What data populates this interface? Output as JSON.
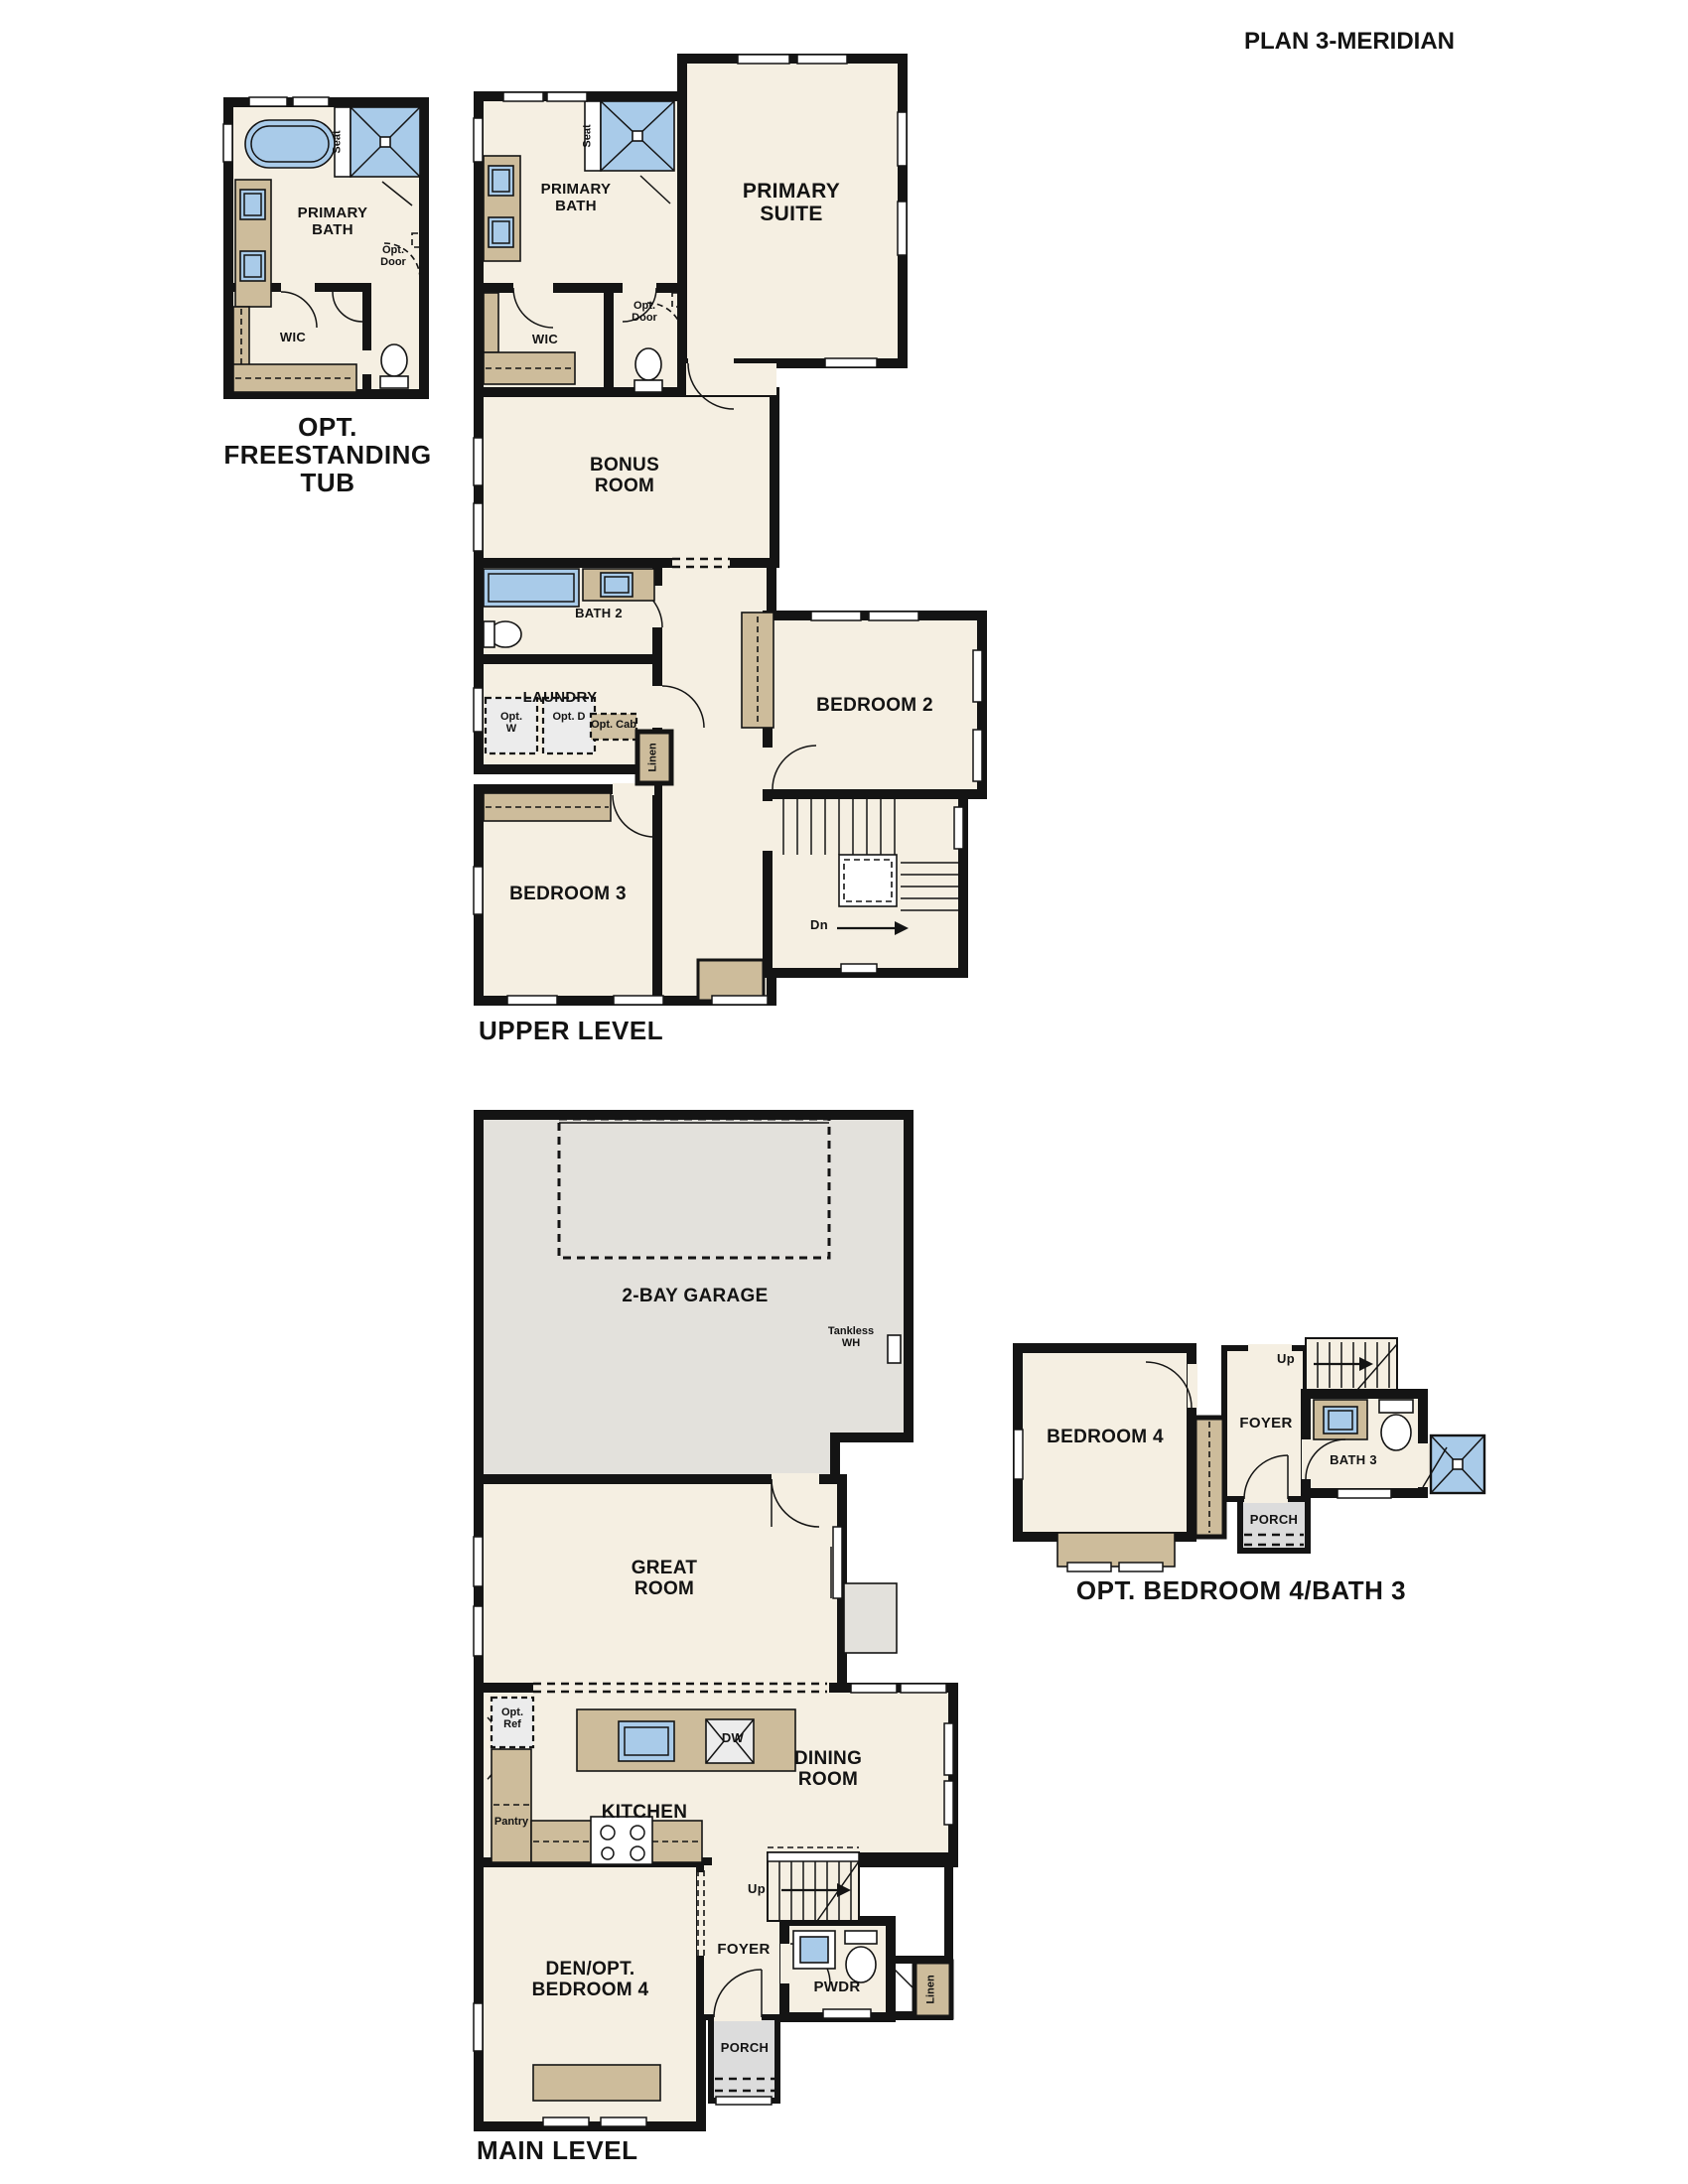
{
  "title": "PLAN 3-MERIDIAN",
  "colors": {
    "floor_cream": "#f5efe2",
    "wall_black": "#141414",
    "fixture_blue": "#a9cbe9",
    "cabinet_tan": "#cdbc9b",
    "garage_gray": "#e3e1dc",
    "porch_gray": "#dcdcdc"
  },
  "opt_tub_detail": {
    "caption": "OPT. FREESTANDING TUB",
    "primary_bath": "PRIMARY BATH",
    "wic": "WIC",
    "seat": "Seat",
    "opt_door": "Opt. Door"
  },
  "upper_level": {
    "caption": "UPPER LEVEL",
    "primary_suite": "PRIMARY SUITE",
    "primary_bath": "PRIMARY BATH",
    "wic": "WIC",
    "seat": "Seat",
    "opt_door": "Opt. Door",
    "bonus_room": "BONUS ROOM",
    "bath_2": "BATH 2",
    "laundry": "LAUNDRY",
    "opt_w": "Opt. W",
    "opt_d": "Opt. D",
    "opt_cab": "Opt. Cab",
    "linen": "Linen",
    "bedroom_2": "BEDROOM 2",
    "bedroom_3": "BEDROOM 3",
    "dn": "Dn"
  },
  "main_level": {
    "caption": "MAIN LEVEL",
    "garage": "2-BAY GARAGE",
    "tankless_wh": "Tankless WH",
    "great_room": "GREAT ROOM",
    "opt_ref": "Opt. Ref",
    "kitchen": "KITCHEN",
    "dw": "DW",
    "pantry": "Pantry",
    "dining_room": "DINING ROOM",
    "up": "Up",
    "den": "DEN/OPT. BEDROOM 4",
    "foyer": "FOYER",
    "pwdr": "PWDR",
    "linen": "Linen",
    "porch": "PORCH"
  },
  "opt_bed4_detail": {
    "caption": "OPT. BEDROOM 4/BATH 3",
    "bedroom_4": "BEDROOM 4",
    "foyer": "FOYER",
    "up": "Up",
    "bath_3": "BATH 3",
    "porch": "PORCH"
  }
}
